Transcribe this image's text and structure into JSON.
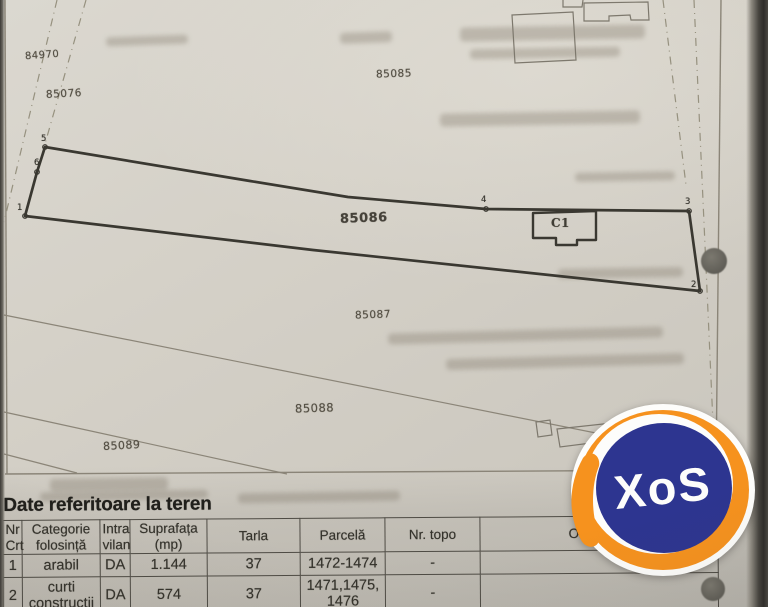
{
  "map": {
    "parcel_labels": [
      {
        "text": "84970"
      },
      {
        "text": "85076"
      },
      {
        "text": "85085"
      },
      {
        "text": "85086"
      },
      {
        "text": "85087"
      },
      {
        "text": "85088"
      },
      {
        "text": "85089"
      }
    ],
    "building_label": "C1",
    "point_labels": [
      {
        "text": "1"
      },
      {
        "text": "2"
      },
      {
        "text": "3"
      },
      {
        "text": "4"
      },
      {
        "text": "5"
      },
      {
        "text": "6"
      }
    ]
  },
  "terrain": {
    "title": "Date referitoare la teren",
    "columns": [
      "Nr Crt",
      "Categorie folosință",
      "Intra vilan",
      "Suprafața (mp)",
      "Tarla",
      "Parcelă",
      "Nr. topo",
      "Observații"
    ],
    "rows": [
      [
        "1",
        "arabil",
        "DA",
        "1.144",
        "37",
        "1472-1474",
        "-",
        ""
      ],
      [
        "2",
        "curti constructii",
        "DA",
        "574",
        "37",
        "1471,1475,1476",
        "-",
        ""
      ]
    ]
  },
  "watermark": {
    "text": "XoS"
  },
  "colors": {
    "paper": "#d5d1c8",
    "ink": "#3a3831",
    "thin_line": "#8b8578",
    "dash_line": "#96917f",
    "label_ink": "#555045",
    "table_border": "#4e4b44",
    "table_ink": "#35332c",
    "watermark_orange": "#f6921e",
    "watermark_blue": "#2d3590",
    "punch_hole": "#6e6b63"
  }
}
